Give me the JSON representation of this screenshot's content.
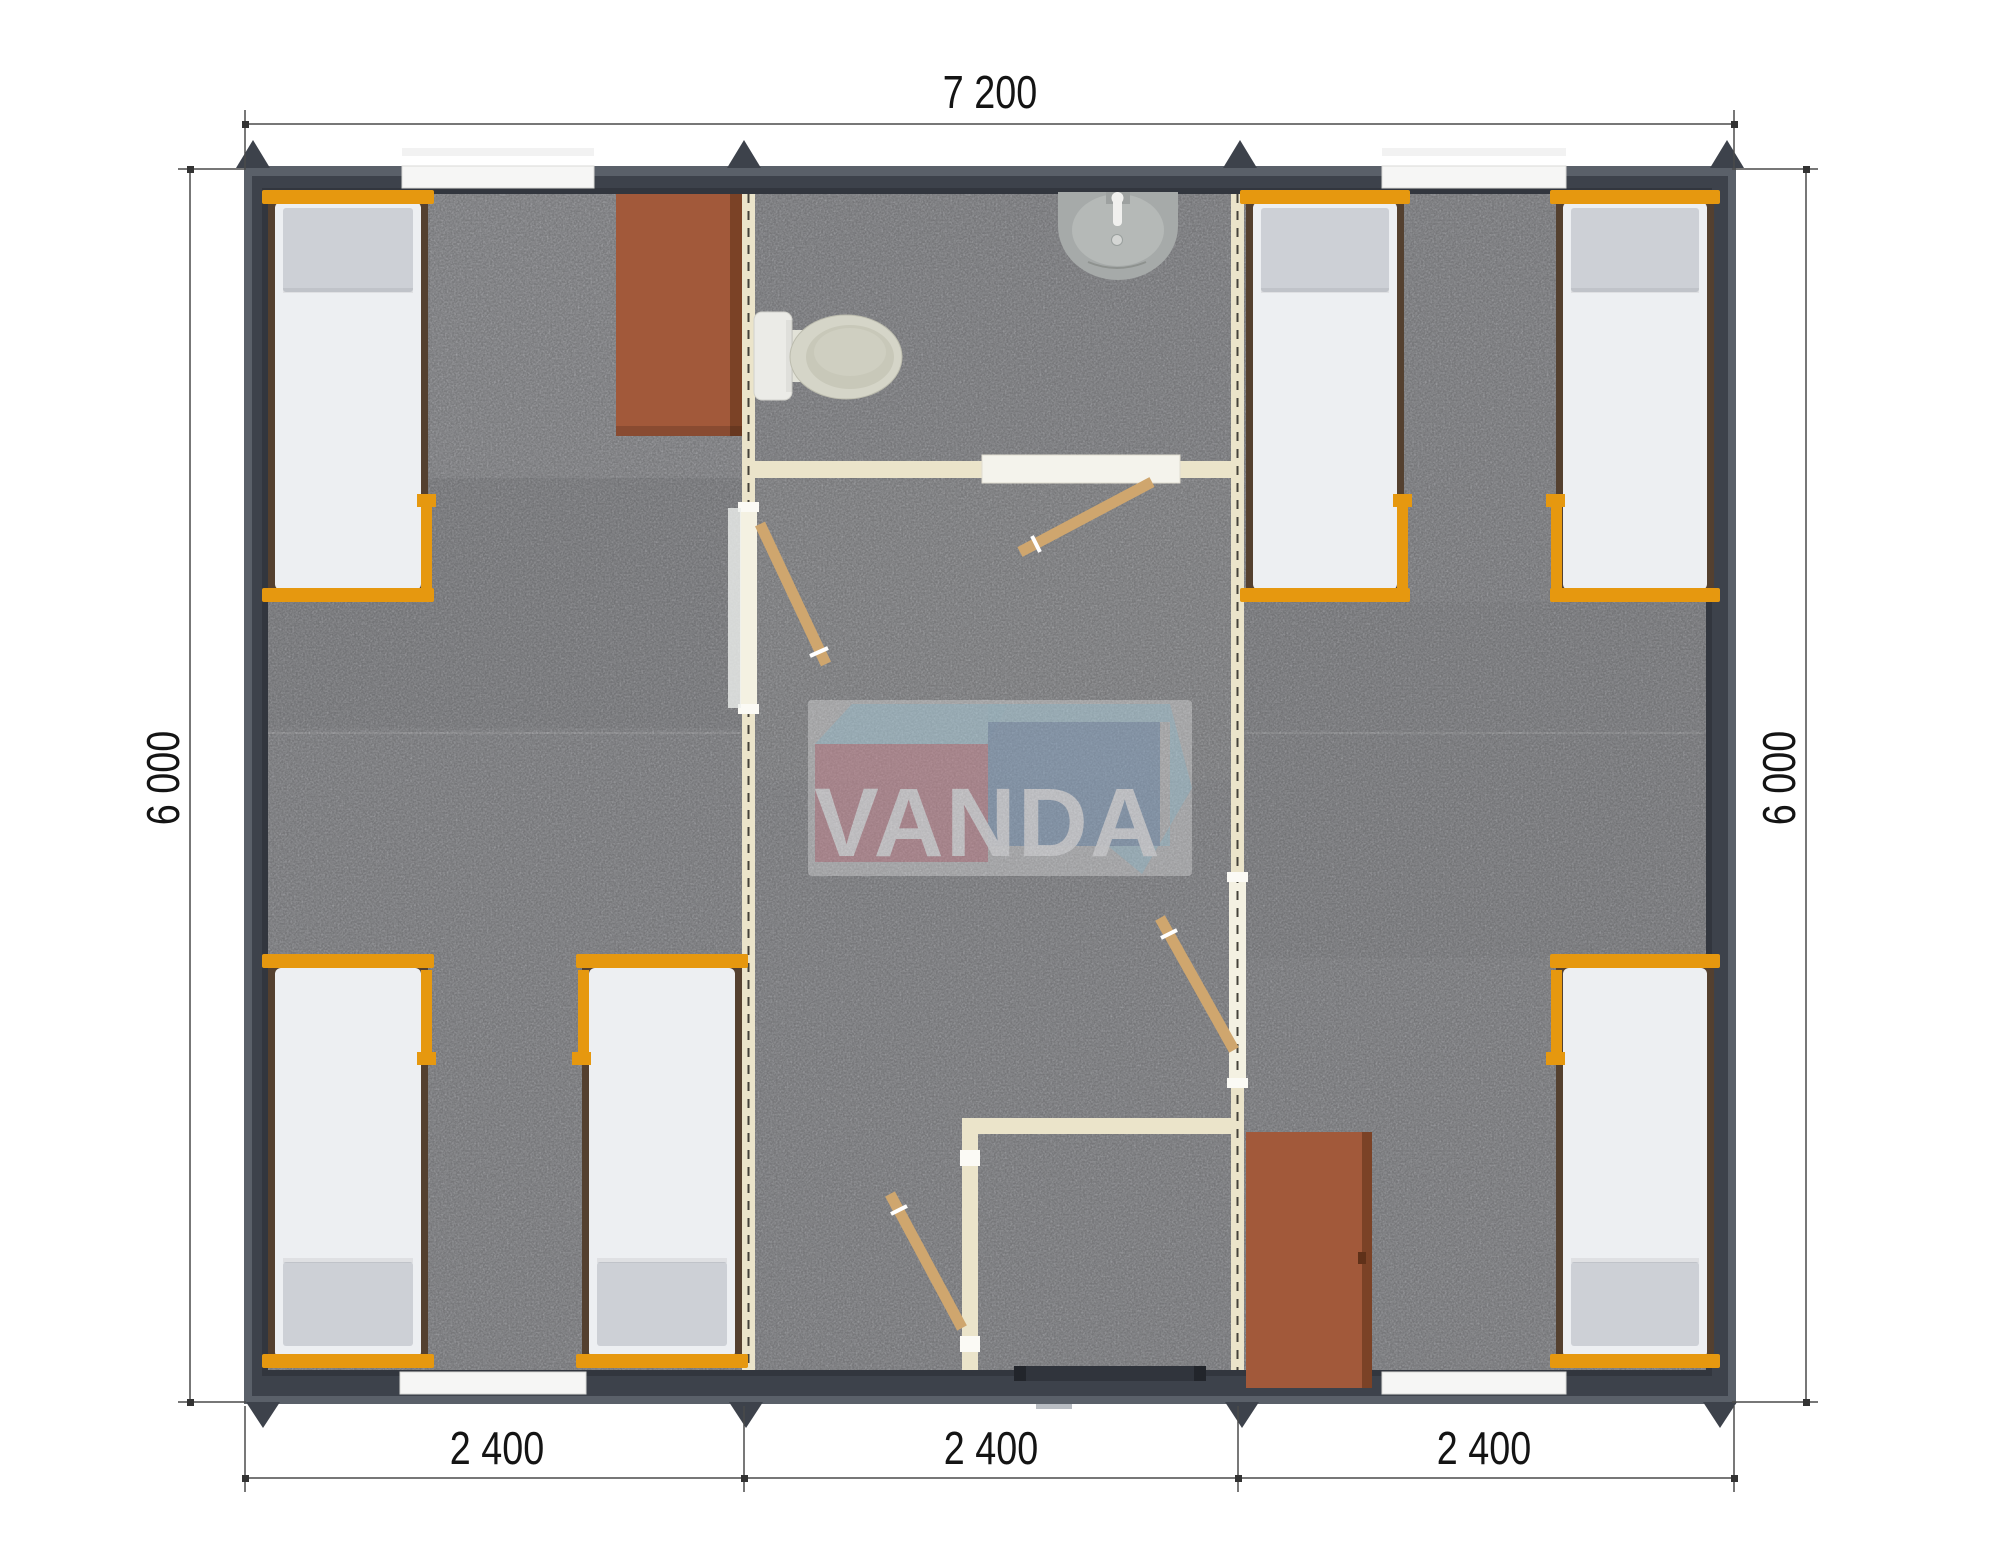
{
  "document": {
    "type": "floor-plan-render",
    "building": "three-module prefab cabin, top view"
  },
  "dimensions": {
    "top_width": "7 200",
    "left_height": "6 000",
    "right_height": "6 000",
    "bottom_segments": [
      "2 400",
      "2 400",
      "2 400"
    ]
  },
  "logo": {
    "text": "VANDA"
  },
  "fixtures": {
    "beds": 6,
    "desks": 1,
    "cabinets": 1,
    "toilet": 1,
    "sink": 1,
    "interior_doors": 4,
    "entrance_doors": 1,
    "windows": 4
  },
  "colors": {
    "wall": "#3d424b",
    "roof_edge": "#5a6069",
    "floor": "#b1b2b6",
    "partition": "#ebe4ca",
    "bed_frame": "#e6980f",
    "mattress": "#edeff2",
    "pillow": "#cdd0d6",
    "furniture_brown": "#a2593a",
    "door_wood": "#cfa66e",
    "logo_red": "#c8818d",
    "logo_blue": "#7f9dc0",
    "logo_lightblue": "#a9cede",
    "dimension_text": "#141414"
  }
}
